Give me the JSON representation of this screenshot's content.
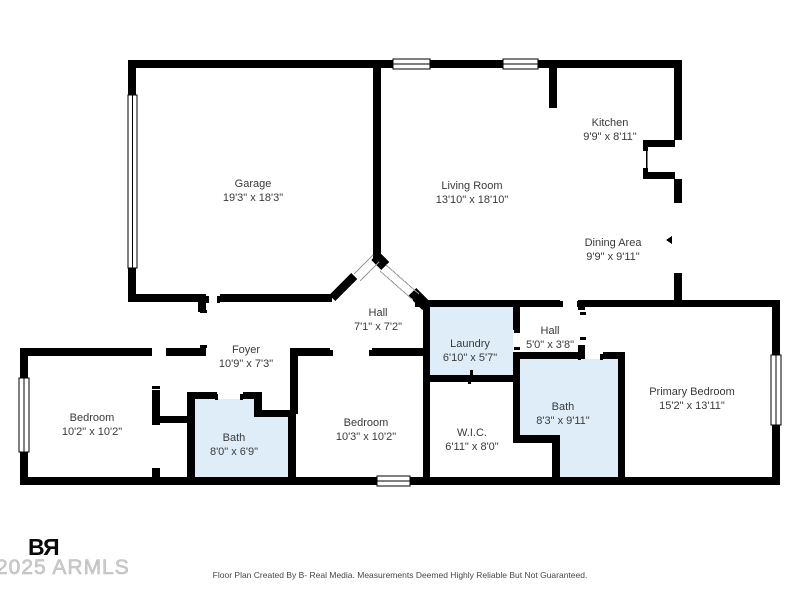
{
  "floor_plan": {
    "rooms": [
      {
        "id": "garage",
        "name": "Garage",
        "dims": "19'3\" x 18'3\""
      },
      {
        "id": "living-room",
        "name": "Living Room",
        "dims": "13'10\" x 18'10\""
      },
      {
        "id": "kitchen",
        "name": "Kitchen",
        "dims": "9'9\" x 8'11\""
      },
      {
        "id": "dining-area",
        "name": "Dining Area",
        "dims": "9'9\" x 9'11\""
      },
      {
        "id": "hall-main",
        "name": "Hall",
        "dims": "7'1\" x 7'2\""
      },
      {
        "id": "foyer",
        "name": "Foyer",
        "dims": "10'9\" x 7'3\""
      },
      {
        "id": "laundry",
        "name": "Laundry",
        "dims": "6'10\" x 5'7\""
      },
      {
        "id": "hall-small",
        "name": "Hall",
        "dims": "5'0\" x 3'8\""
      },
      {
        "id": "primary-bedroom",
        "name": "Primary Bedroom",
        "dims": "15'2\" x 13'11\""
      },
      {
        "id": "bedroom-left",
        "name": "Bedroom",
        "dims": "10'2\" x 10'2\""
      },
      {
        "id": "bath-left",
        "name": "Bath",
        "dims": "8'0\" x 6'9\""
      },
      {
        "id": "bedroom-middle",
        "name": "Bedroom",
        "dims": "10'3\" x 10'2\""
      },
      {
        "id": "wic",
        "name": "W.I.C.",
        "dims": "6'11\" x 8'0\""
      },
      {
        "id": "bath-right",
        "name": "Bath",
        "dims": "8'3\" x 9'11\""
      }
    ],
    "colors": {
      "wall": "#000000",
      "highlight": "#dfedf8",
      "label": "#3a3a3a"
    }
  },
  "footer": {
    "logo": {
      "b": "B",
      "r": "R"
    },
    "watermark": "2025 ARMLS",
    "disclaimer": "Floor Plan Created By B- Real Media. Measurements Deemed Highly Reliable But Not Guaranteed."
  }
}
